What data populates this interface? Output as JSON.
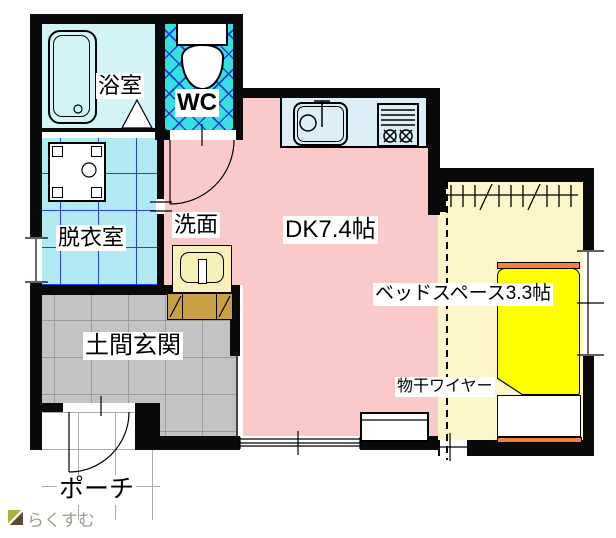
{
  "rooms": {
    "bath": {
      "label": "浴室"
    },
    "wc": {
      "label": "WC"
    },
    "dressing": {
      "label": "脱衣室"
    },
    "washbasin": {
      "label": "洗面"
    },
    "dk": {
      "label": "DK7.4帖"
    },
    "bedspace": {
      "label": "ベッドスペース3.3帖"
    },
    "doma": {
      "label": "土間玄関"
    },
    "porch": {
      "label": "ポーチ"
    }
  },
  "annotations": {
    "laundry_wire": "物干ワイヤー"
  },
  "watermark": {
    "text": "らくすむ"
  },
  "colors": {
    "dk-pink": "#FAC9C9",
    "bath-cyan": "#D2F4F6",
    "dressing-cyan": "#B2EAF4",
    "wc-cyan": "#35E0E3",
    "lattice-blue": "#1E3FD1",
    "grid-blue": "#2742E8",
    "bedspace-cream": "#FCF6CA",
    "bed-yellow": "#FFFF00",
    "bed-orange": "#F28038",
    "doma-gray": "#C3C3C3",
    "doma-grid": "#9B9B9B",
    "porch-grid": "#ABABAB",
    "counter-blue": "#DCEFF8",
    "basin-cream": "#F7F0B8",
    "cabinet-tan": "#C9A144",
    "wall-black": "#0A0A0A",
    "watermark-gray": "#A39B85",
    "logo-olive": "#A9B23B",
    "logo-brown": "#5C4A33"
  }
}
